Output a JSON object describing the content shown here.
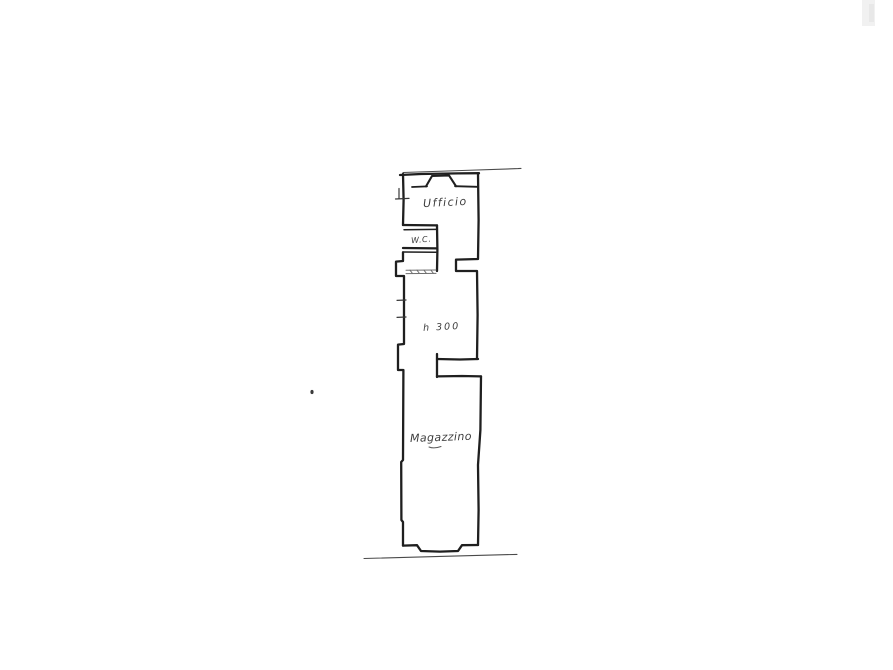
{
  "page": {
    "background": "#ffffff",
    "ink_color": "#1f1f1f",
    "thin_line_color": "#4a4a4a",
    "text_ink_color": "#3d3d3d"
  },
  "floor_plan": {
    "labels": {
      "ufficio": "Ufficio",
      "wc": "W.C.",
      "height_annotation": "h 300",
      "magazzino": "Magazzino"
    }
  }
}
